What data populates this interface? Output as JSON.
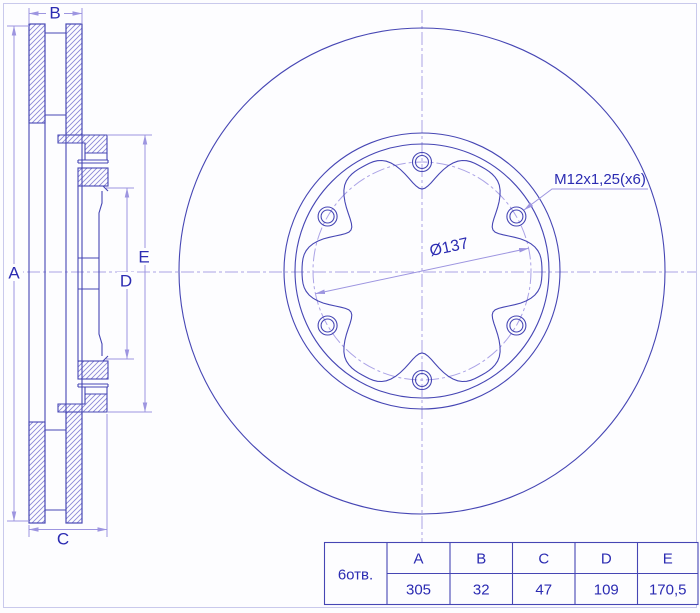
{
  "drawing": {
    "dim_labels": {
      "A": "A",
      "B": "B",
      "C": "C",
      "D": "D",
      "E": "E"
    },
    "thread_label": "M12x1,25(x6)",
    "diameter_label": "Ø137"
  },
  "table": {
    "row_label": "6отв.",
    "columns": [
      "A",
      "B",
      "C",
      "D",
      "E"
    ],
    "values": [
      "305",
      "32",
      "47",
      "109",
      "170,5"
    ]
  },
  "colors": {
    "main_line": "#4646b4",
    "dim_line": "#9d95e0",
    "centerline": "#aba3e6",
    "hatch": "#8b88d6",
    "text": "#2b2bb2",
    "frame": "#c9c9ec",
    "background": "#fdfdff"
  }
}
